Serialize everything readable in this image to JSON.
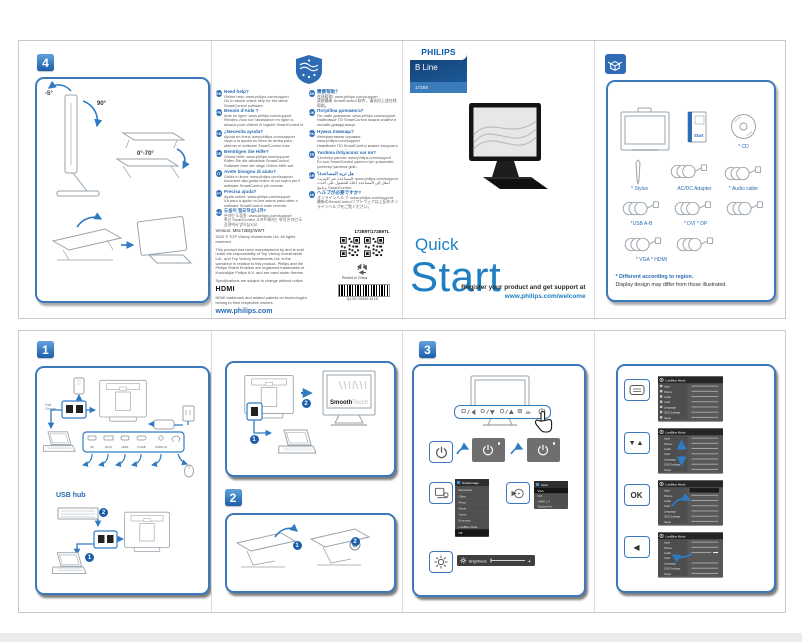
{
  "marks": {
    "one": "1",
    "two": "2"
  },
  "step4": {
    "badge": "4",
    "angle_minus5": "-5°",
    "angle_90": "90°",
    "angle_range": "0°-70°"
  },
  "help": {
    "left": [
      {
        "code": "EN",
        "title": "Need help?",
        "l1": "Online help: www.philips.com/support",
        "l2": "Go to above online help for the latest SmartControl software."
      },
      {
        "code": "FR",
        "title": "Besoin d'Aide ?",
        "l1": "Aide en ligne: www.philips.com/support",
        "l2": "Rendez-vous sur l'assistance en ligne ci-dessus pour obtenir le logiciel SmartControl le plus récent."
      },
      {
        "code": "ES",
        "title": "¿Necesita ayuda?",
        "l1": "Ayuda en línea: www.philips.com/support",
        "l2": "Vaya a la ayuda en línea de arriba para obtener el software SmartControl más actualizado."
      },
      {
        "code": "DE",
        "title": "Benötigen Sie Hilfe?",
        "l1": "Online-Hilfe: www.philips.com/support",
        "l2": "Rufen Sie die aktuellste SmartControl Software über die obige Online-Hilfe auf."
      },
      {
        "code": "IT",
        "title": "Avete bisogno di aiuto?",
        "l1": "Guida in linea: www.philips.com/support",
        "l2": "Accedere alla guida online di cui sopra per il software SmartControl più recente."
      },
      {
        "code": "PT",
        "title": "Precisa ajuda?",
        "l1": "Ajuda online: www.philips.com/support",
        "l2": "Vá para a ajuda on-line acima para obter o software SmartControl mais recente."
      },
      {
        "code": "KO",
        "title": "도움이 필요하십니까?",
        "l1": "온라인 도움말: www.philips.com/support",
        "l2": "최신 SmartControl 소프트웨어는 위의 온라인 도움말에서 받으십시오."
      }
    ],
    "right": [
      {
        "code": "ZH",
        "title": "需要帮助？",
        "l1": "在线帮助: www.philips.com/support",
        "l2": "获取最新 SmartControl 软件，请访问上述在线帮助。"
      },
      {
        "code": "UK",
        "title": "Потрібна допомога?",
        "l1": "Он-лайн допомога: www.philips.com/support",
        "l2": "Найновіше ПЗ SmartControl можна знайти в онлайн-довідці вище."
      },
      {
        "code": "RU",
        "title": "Нужна помощь?",
        "l1": "Интерактивная справка: www.philips.com/support",
        "l2": "Новейшее ПО SmartControl можно загрузить в интерактивной справке выше."
      },
      {
        "code": "TR",
        "title": "Yardıma ihtiyacınız var mı?",
        "l1": "Çevrimiçi yardım: www.philips.com/support",
        "l2": "En son SmartControl yazılımı için yukarıdaki çevrimiçi yardıma gidin."
      },
      {
        "code": "AR",
        "title": "هل تريد المساعدة؟",
        "l1": "المساعدة عبر الإنترنت: www.philips.com/support",
        "l2": "انتقل إلى المساعدة أعلاه للحصول على أحدث برنامج SmartControl."
      },
      {
        "code": "JA",
        "title": "ヘルプが必要ですか?",
        "l1": "オンラインヘルプ: www.philips.com/support",
        "l2": "最新のSmartControlソフトウェアは上記のオンラインヘルプをご覧ください。"
      }
    ],
    "version": "Version: M6172BQ/WWT",
    "copyright": "2020 © TOP Victory Investments Ltd. All rights reserved.",
    "legal": "This product has been manufactured by and is sold under the responsibility of Top Victory Investments Ltd., and Top Victory Investments Ltd. is the warrantor in relation to this product. Philips and the Philips Shield Emblem are registered trademarks of Koninklijke Philips N.V. and are used under license.",
    "specs": "Specifications are subject to change without notice.",
    "hdmi": "HDMI",
    "hdmi_note": "HDMI trademark and related patents on technologies belong to their respective owners.",
    "site": "www.philips.com",
    "model": "172B9T/172B9TL",
    "printed": "Printed in China",
    "barcode": "Q40G70M5E101D"
  },
  "cover": {
    "brand": "PHILIPS",
    "series": "B Line",
    "model": "172B9",
    "quick": "Quick",
    "start": "Start",
    "reg1": "Register your product and get support at",
    "reg2": "www.philips.com/welcome"
  },
  "box": {
    "cd": "* CD",
    "stylus": "* Stylus",
    "adapter": "AC/DC Adapter",
    "audio": "* Audio cable",
    "usb": "*USB A-B",
    "dvi_dp": "* DVI * DP",
    "vga_hdmi": "* VGA * HDMI",
    "start": "Start",
    "note1": "* Different according to region.",
    "note2": "Display design may differ from those illustrated."
  },
  "step1": {
    "badge": "1",
    "usb_hub": "USB hub",
    "fc1": "Fast",
    "fc2": "Charger",
    "ports": [
      "DP",
      "DVI-D",
      "HDMI",
      "D-SUB",
      "AUDIO IN"
    ]
  },
  "step2": {
    "badge": "2",
    "smooth": "Smooth",
    "touch": "Touch"
  },
  "step3": {
    "badge": "3",
    "smartimage": {
      "title": "SmartImage",
      "items": [
        "EasyRead",
        "Office",
        "Photo",
        "Movie",
        "Game",
        "Economy",
        "LowBlue Mode",
        "Off"
      ]
    },
    "input": {
      "title": "Input",
      "items": [
        "VGA",
        "DVI",
        "HDMI 1.4",
        "DisplayPort"
      ]
    },
    "brightness": {
      "label": "Brightness",
      "plus": "+"
    }
  },
  "osdnav": {
    "updown": "▼▲",
    "ok": "OK",
    "back": "◀",
    "menu": {
      "header": "LowBlue Mode",
      "items": [
        "Input",
        "Picture",
        "Audio",
        "Color",
        "Language",
        "OSD Settings",
        "Setup"
      ]
    }
  }
}
